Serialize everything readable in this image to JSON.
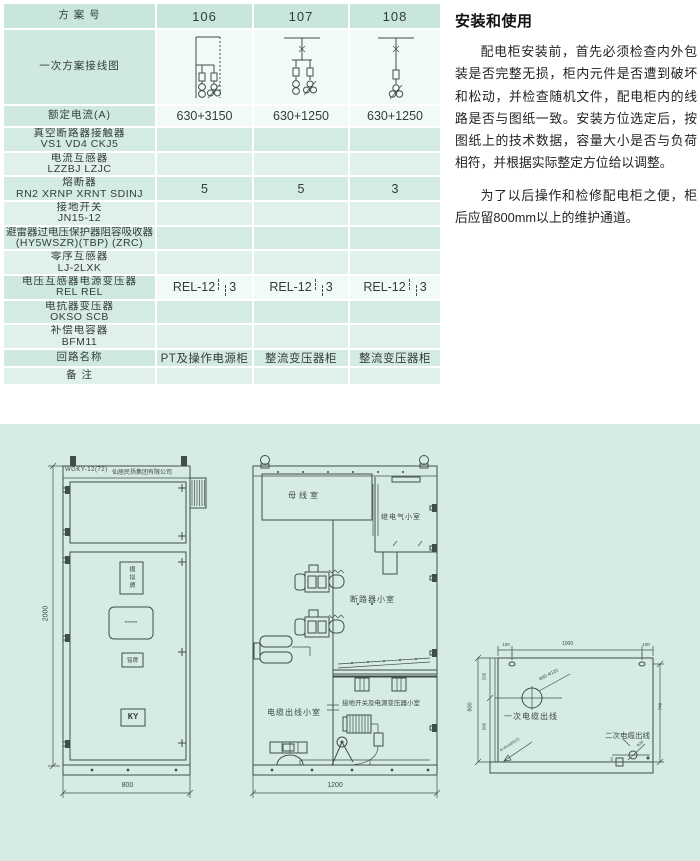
{
  "table": {
    "header": {
      "label": "方  案  号",
      "schemes": [
        "106",
        "107",
        "108"
      ]
    },
    "rows": [
      {
        "label": "一次方案接线图"
      },
      {
        "label": "额定电流(A)",
        "values": [
          "630+3150",
          "630+1250",
          "630+1250"
        ]
      },
      {
        "label": "真空断路器接触器",
        "label2": "VS1 VD4 CKJ5",
        "values": [
          "",
          "",
          ""
        ]
      },
      {
        "label": "电流互感器",
        "label2": "LZZBJ LZJC",
        "values": [
          "",
          "",
          ""
        ]
      },
      {
        "label": "熔断器",
        "label2": "RN2 XRNP XRNT SDINJ",
        "values": [
          "5",
          "5",
          "3"
        ]
      },
      {
        "label": "接地开关",
        "label2": "JN15-12",
        "values": [
          "",
          "",
          ""
        ]
      },
      {
        "label": "避雷器过电压保护器阻容吸收器",
        "label2": "(HY5WSZR)(TBP) (ZRC)",
        "values": [
          "",
          "",
          ""
        ]
      },
      {
        "label": "零序互感器",
        "label2": "LJ-2LXK",
        "values": [
          "",
          "",
          ""
        ]
      },
      {
        "label": "电压互感器电源变压器",
        "label2": "REL REL",
        "rel": "REL-12",
        "rel2": "3"
      },
      {
        "label": "电抗器变压器",
        "label2": "OKSO SCB",
        "values": [
          "",
          "",
          ""
        ]
      },
      {
        "label": "补偿电容器",
        "label2": "BFM11",
        "values": [
          "",
          "",
          ""
        ]
      },
      {
        "label": "回路名称",
        "values": [
          "PT及操作电源柜",
          "整流变压器柜",
          "整流变压器柜"
        ]
      },
      {
        "label": "备    注",
        "values": [
          "",
          "",
          ""
        ]
      }
    ]
  },
  "article": {
    "title": "安装和使用",
    "p1": "配电柜安装前，首先必须检查内外包装是否完整无损，柜内元件是否遭到破坏和松动，并检查随机文件，配电柜内的线路是否与图纸一致。安装方位选定后，按图纸上的技术数据，容量大小是否与负荷相符，并根据实际整定方位给以调整。",
    "p2": "为了以后操作和检修配电柜之便，柜后应留800mm以上的维护通道。"
  },
  "drawings": {
    "front": {
      "model": "WGKY-12(72)",
      "company": "仙居民扬集团有限公司",
      "mimic_board": "模拟牌",
      "micro_label": "▪▪▪▪▪▪▪▪▪",
      "nameplate": "铭牌",
      "logo": "KY",
      "dim_height": "2000",
      "dim_width": "800"
    },
    "section": {
      "busbar_room": "母线室",
      "relay_room": "继电气小室",
      "breaker_room": "断路器小室",
      "cable_room": "电缆出线小室",
      "earth_room": "接地开关及电源变压器小室",
      "dim_depth": "1200"
    },
    "plan": {
      "dim_top_left": "100",
      "dim_top_center": "1000",
      "dim_top_right": "100",
      "dim_left_total": "800",
      "dim_left_upper": "295",
      "dim_left_lower": "505",
      "dim_right": "740",
      "hole_note": "Φ80 Φ120",
      "bolt_note": "4×Φ14(M12)",
      "sec_hole_note": "Φ30",
      "sec_offset": "60",
      "primary_label": "一次电缆出线",
      "secondary_label": "二次电缆出线"
    }
  },
  "colors": {
    "panel": "#d7ebe5",
    "line": "#3e4e4b",
    "row_mint": "#cfe9e0"
  }
}
